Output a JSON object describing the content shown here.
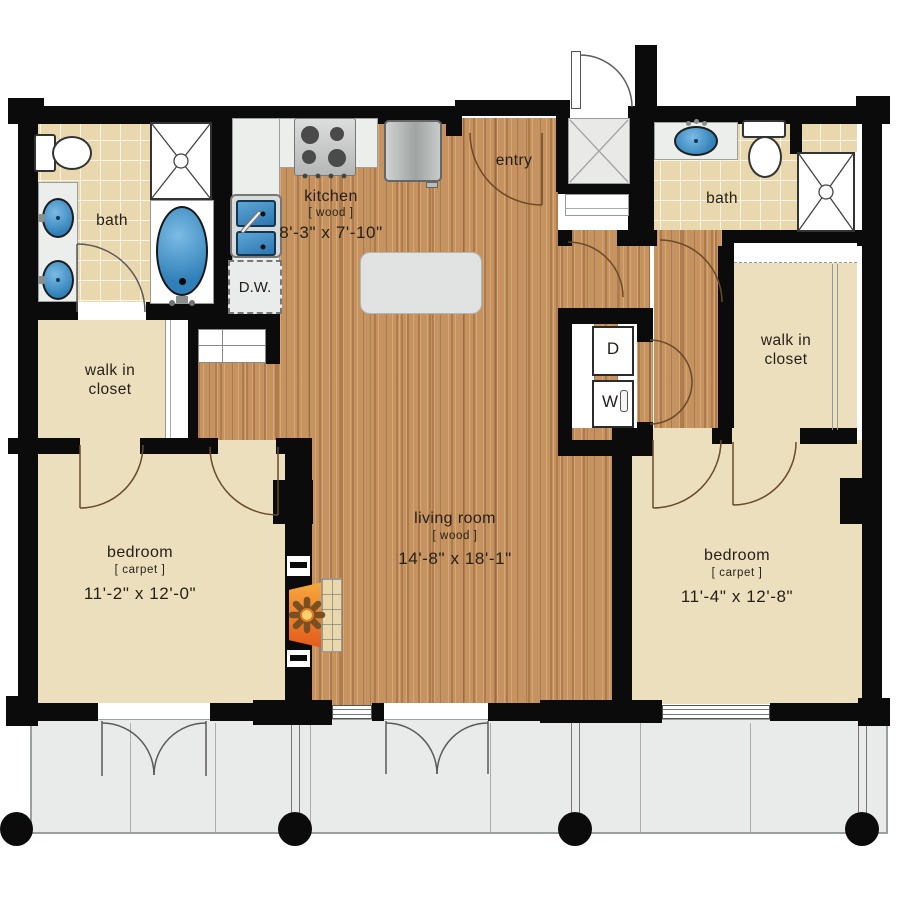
{
  "rooms": {
    "bath_left": {
      "name": "bath"
    },
    "bath_right": {
      "name": "bath"
    },
    "kitchen": {
      "name": "kitchen",
      "floor": "[ wood ]",
      "dims": "8'-3\" x 7'-10\""
    },
    "entry": {
      "name": "entry"
    },
    "walk_in_closet_left": {
      "line1": "walk in",
      "line2": "closet"
    },
    "walk_in_closet_right": {
      "line1": "walk in",
      "line2": "closet"
    },
    "bedroom_left": {
      "name": "bedroom",
      "floor": "[ carpet ]",
      "dims": "11'-2\" x 12'-0\""
    },
    "bedroom_right": {
      "name": "bedroom",
      "floor": "[ carpet ]",
      "dims": "11'-4\" x 12'-8\""
    },
    "living_room": {
      "name": "living room",
      "floor": "[ wood ]",
      "dims": "14'-8\" x 18'-1\""
    }
  },
  "appliances": {
    "dishwasher_label": "D.W.",
    "dryer_label": "D",
    "washer_label": "W"
  },
  "colors": {
    "wall": "#0b0b0b",
    "wood": "#c6925e",
    "carpet": "#ecdfbe",
    "tile": "#e9d7ad",
    "balcony": "#e9ebea",
    "counter": "#eceeec",
    "fixture_blue": "#2f7fb8",
    "fireplace_orange": "#e55a1a",
    "hearth": "#e9d8ac"
  }
}
